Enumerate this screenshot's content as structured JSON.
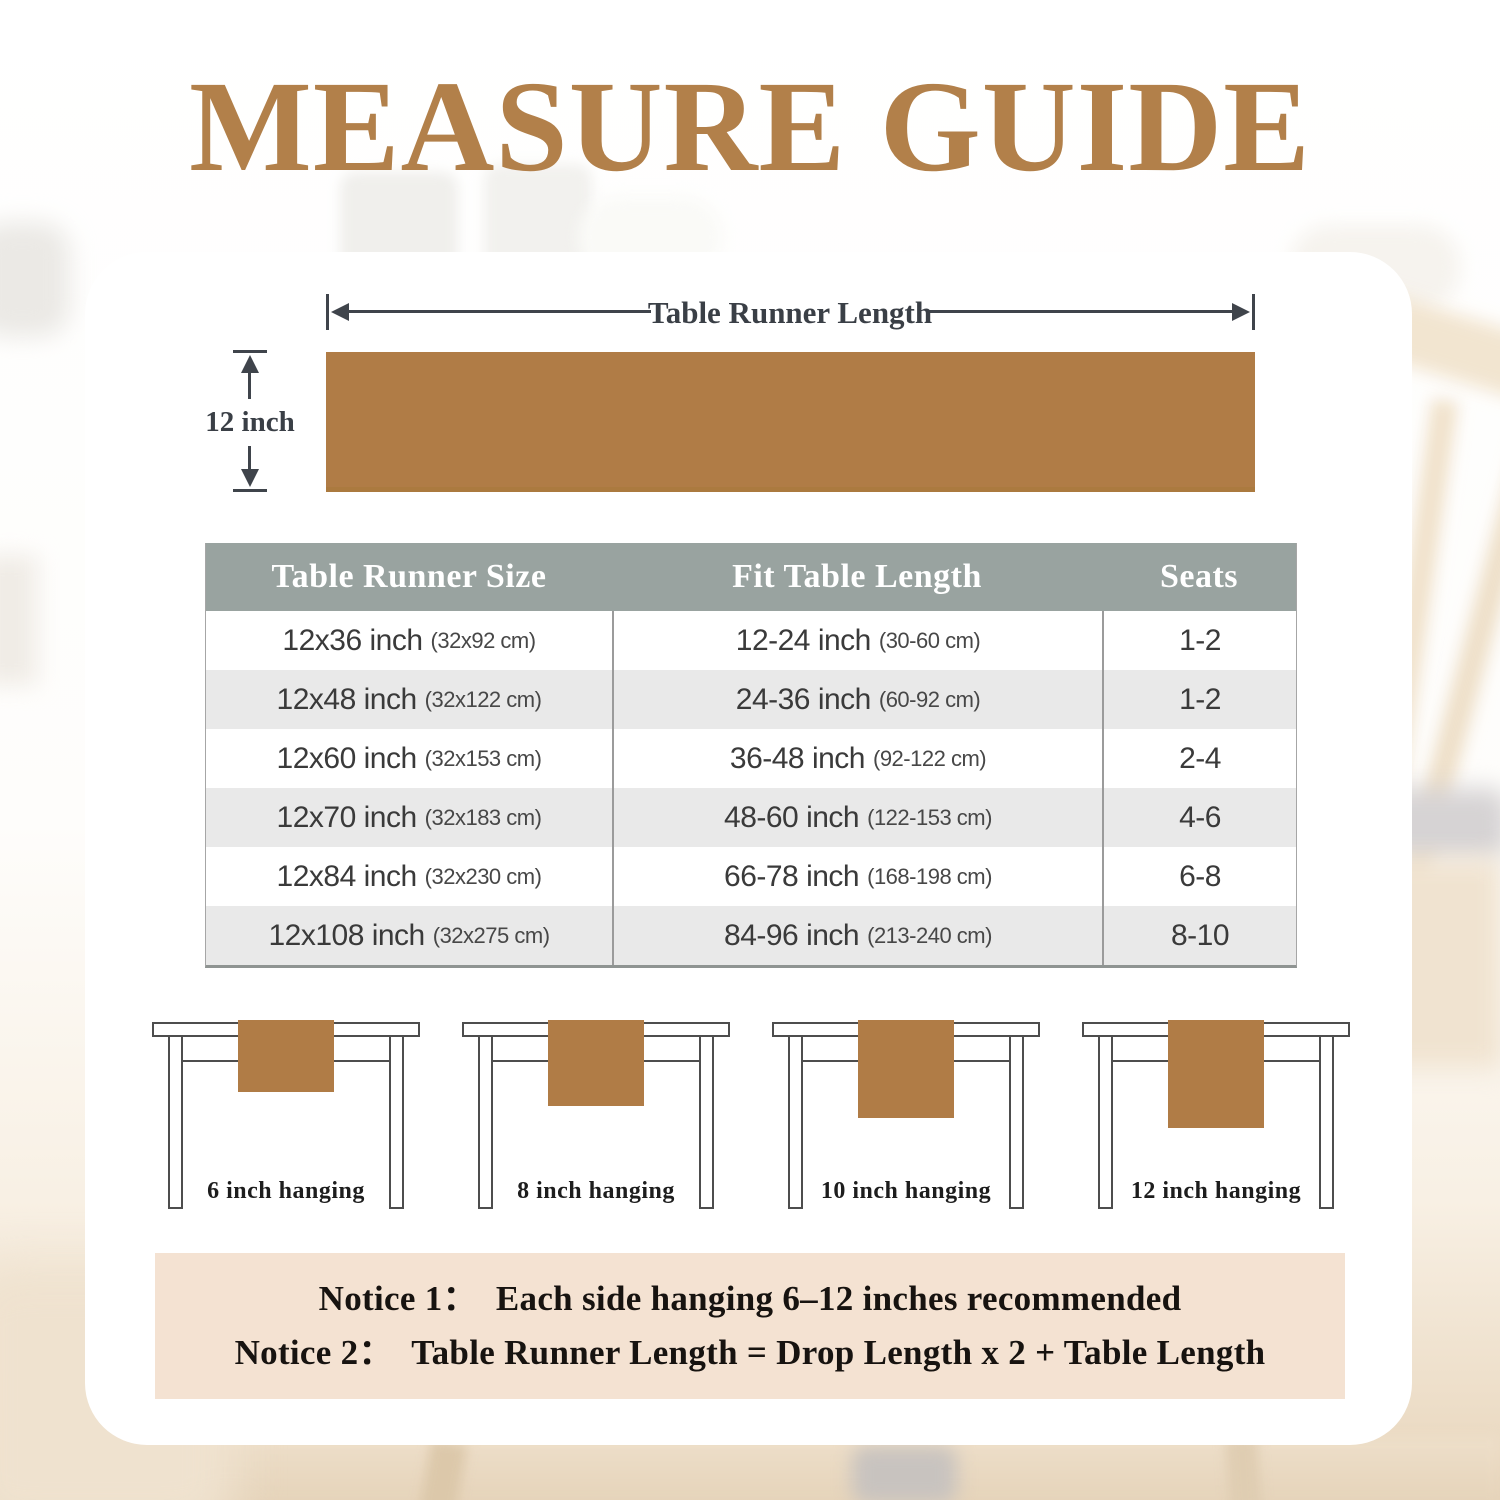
{
  "title": "MEASURE GUIDE",
  "diagram": {
    "length_label": "Table Runner Length",
    "width_label": "12 inch"
  },
  "size_table": {
    "headers": [
      "Table Runner Size",
      "Fit Table Length",
      "Seats"
    ],
    "rows": [
      {
        "size": "12x36 inch",
        "size_cm": "(32x92 cm)",
        "fit": "12-24 inch",
        "fit_cm": "(30-60 cm)",
        "seats": "1-2"
      },
      {
        "size": "12x48 inch",
        "size_cm": "(32x122 cm)",
        "fit": "24-36 inch",
        "fit_cm": "(60-92 cm)",
        "seats": "1-2"
      },
      {
        "size": "12x60 inch",
        "size_cm": "(32x153 cm)",
        "fit": "36-48 inch",
        "fit_cm": "(92-122 cm)",
        "seats": "2-4"
      },
      {
        "size": "12x70 inch",
        "size_cm": "(32x183 cm)",
        "fit": "48-60 inch",
        "fit_cm": "(122-153 cm)",
        "seats": "4-6"
      },
      {
        "size": "12x84 inch",
        "size_cm": "(32x230 cm)",
        "fit": "66-78 inch",
        "fit_cm": "(168-198 cm)",
        "seats": "6-8"
      },
      {
        "size": "12x108 inch",
        "size_cm": "(32x275 cm)",
        "fit": "84-96 inch",
        "fit_cm": "(213-240 cm)",
        "seats": "8-10"
      }
    ]
  },
  "hanging_examples": [
    {
      "label": "6 inch hanging"
    },
    {
      "label": "8 inch hanging"
    },
    {
      "label": "10 inch hanging"
    },
    {
      "label": "12 inch hanging"
    }
  ],
  "notices": {
    "line1": "Notice 1：  Each side hanging 6–12 inches recommended",
    "line2": "Notice 2：  Table Runner Length = Drop Length x 2 + Table Length"
  },
  "colors": {
    "title_brown": "#b2804a",
    "runner_brown": "#b07c46",
    "table_header_bg": "#99a3a0",
    "table_row_alt_bg": "#e9e9e9",
    "notice_bg": "#f4e2d2",
    "dimension_line": "#3f444b"
  }
}
